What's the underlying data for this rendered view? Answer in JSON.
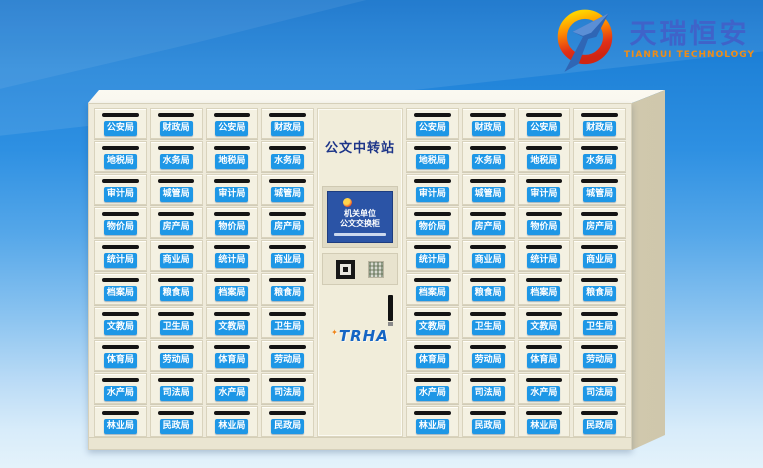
{
  "brand": {
    "name_cn": "天瑞恒安",
    "name_en": "TIANRUI TECHNOLOGY",
    "name_cn_color": "#3f63c9",
    "name_en_color": "#ef8d17",
    "logo_icon": "ring-arrow-logo",
    "logo_ring_colors": [
      "#ffd200",
      "#ff8a00",
      "#e03018"
    ],
    "logo_arrow_color": "#2f66b5"
  },
  "cabinet": {
    "title": "公文中转站",
    "title_color": "#1d3589",
    "body_color": "#efebdb",
    "door_label_color": "#1e97e6",
    "screen": {
      "emblem_icon": "national-emblem",
      "line1": "机关单位",
      "line2": "公文交换柜",
      "bg_color": "#2b54a6"
    },
    "reader": {
      "qr_icon": "qr-code",
      "sticker_icon": "instruction-sticker"
    },
    "door_brand": "TRHA"
  },
  "lockers": {
    "rows": 10,
    "columns": [
      {
        "id": 1,
        "labels": [
          "公安局",
          "地税局",
          "审计局",
          "物价局",
          "统计局",
          "档案局",
          "文教局",
          "体育局",
          "水产局",
          "林业局"
        ]
      },
      {
        "id": 2,
        "labels": [
          "财政局",
          "水务局",
          "城管局",
          "房产局",
          "商业局",
          "粮食局",
          "卫生局",
          "劳动局",
          "司法局",
          "民政局"
        ]
      },
      {
        "id": 3,
        "labels": [
          "公安局",
          "地税局",
          "审计局",
          "物价局",
          "统计局",
          "档案局",
          "文教局",
          "体育局",
          "水产局",
          "林业局"
        ]
      },
      {
        "id": 4,
        "labels": [
          "财政局",
          "水务局",
          "城管局",
          "房产局",
          "商业局",
          "粮食局",
          "卫生局",
          "劳动局",
          "司法局",
          "民政局"
        ]
      },
      {
        "id": 5,
        "labels": [
          "公安局",
          "地税局",
          "审计局",
          "物价局",
          "统计局",
          "档案局",
          "文教局",
          "体育局",
          "水产局",
          "林业局"
        ]
      },
      {
        "id": 6,
        "labels": [
          "财政局",
          "水务局",
          "城管局",
          "房产局",
          "商业局",
          "粮食局",
          "卫生局",
          "劳动局",
          "司法局",
          "民政局"
        ]
      },
      {
        "id": 7,
        "labels": [
          "公安局",
          "地税局",
          "审计局",
          "物价局",
          "统计局",
          "档案局",
          "文教局",
          "体育局",
          "水产局",
          "林业局"
        ]
      },
      {
        "id": 8,
        "labels": [
          "财政局",
          "水务局",
          "城管局",
          "房产局",
          "商业局",
          "粮食局",
          "卫生局",
          "劳动局",
          "司法局",
          "民政局"
        ]
      }
    ]
  }
}
